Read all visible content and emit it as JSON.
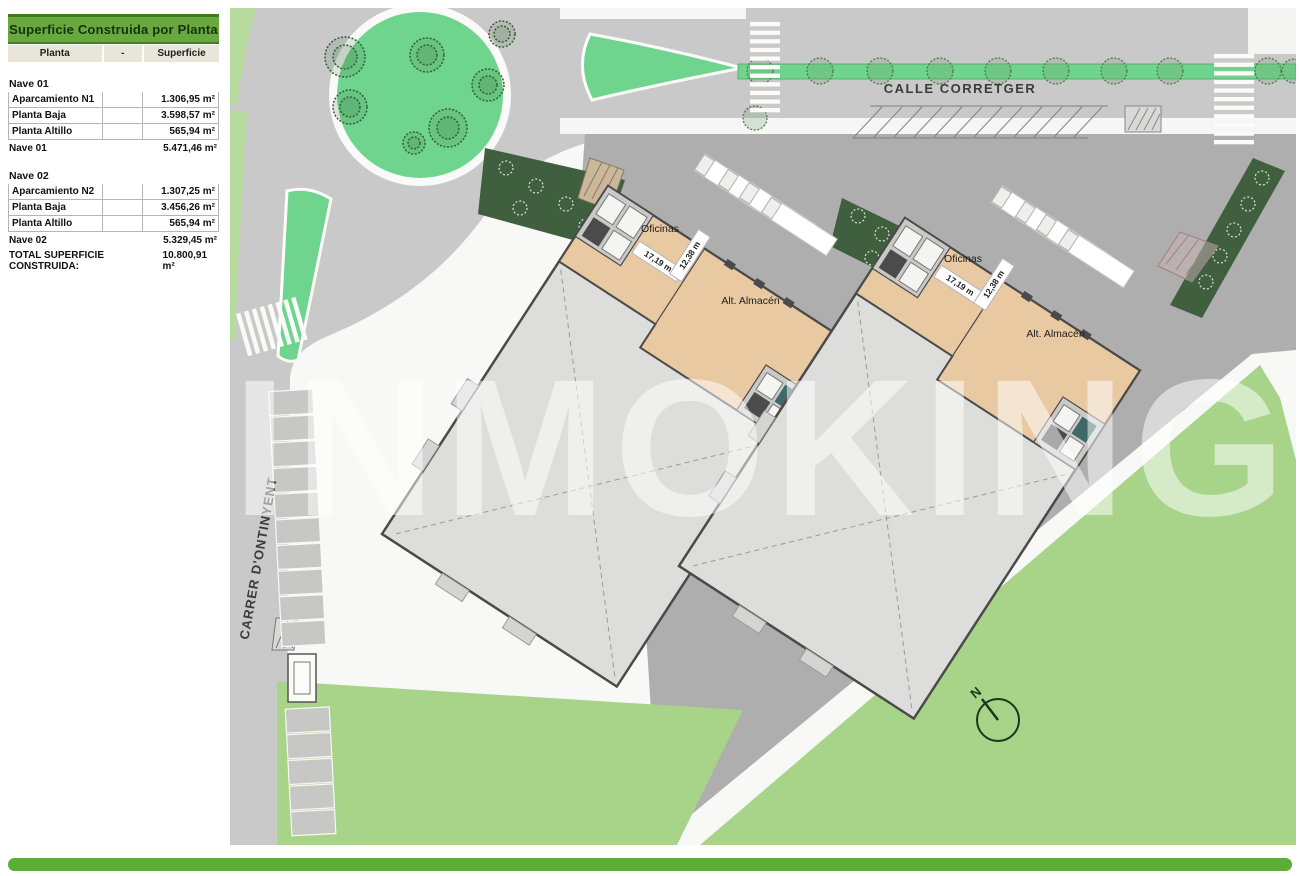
{
  "table": {
    "title": "Superficie Construida por Planta",
    "columns": [
      "Planta",
      "-",
      "Superficie"
    ],
    "sections": [
      {
        "name": "Nave 01",
        "rows": [
          [
            "Aparcamiento N1",
            "",
            "1.306,95 m²"
          ],
          [
            "Planta Baja",
            "",
            "3.598,57 m²"
          ],
          [
            "Planta Altillo",
            "",
            "565,94 m²"
          ]
        ],
        "subtotal_label": "Nave 01",
        "subtotal_value": "5.471,46 m²"
      },
      {
        "name": "Nave 02",
        "rows": [
          [
            "Aparcamiento N2",
            "",
            "1.307,25 m²"
          ],
          [
            "Planta Baja",
            "",
            "3.456,26 m²"
          ],
          [
            "Planta Altillo",
            "",
            "565,94 m²"
          ]
        ],
        "subtotal_label": "Nave 02",
        "subtotal_value": "5.329,45 m²"
      }
    ],
    "total_label": "TOTAL SUPERFICIE CONSTRUIDA:",
    "total_value": "10.800,91 m²"
  },
  "plan": {
    "streets": {
      "top": "CALLE CORRETGER",
      "left": "CARRER D'ONTINYENT"
    },
    "buildings": [
      {
        "office": "Oficinas",
        "warehouse": "Alt. Almacén",
        "dim_w": "17,19 m",
        "dim_h": "12,38 m"
      },
      {
        "office": "Oficinas",
        "warehouse": "Alt. Almacén",
        "dim_w": "17,19 m",
        "dim_h": "12,38 m"
      }
    ],
    "compass_label": "N",
    "watermark": "INMOKING"
  },
  "colors": {
    "header_green": "#68a83f",
    "footer_green": "#5cad33",
    "roundabout_green": "#6fd48d",
    "field_green": "#a8d489",
    "verge_green": "#b7db9d",
    "hedge_green": "#3f5f3e",
    "road_gray": "#c9c9c9",
    "yard_gray": "#aeaeae",
    "building_tan": "#e9c9a1",
    "hall_gray": "#dddddc"
  }
}
